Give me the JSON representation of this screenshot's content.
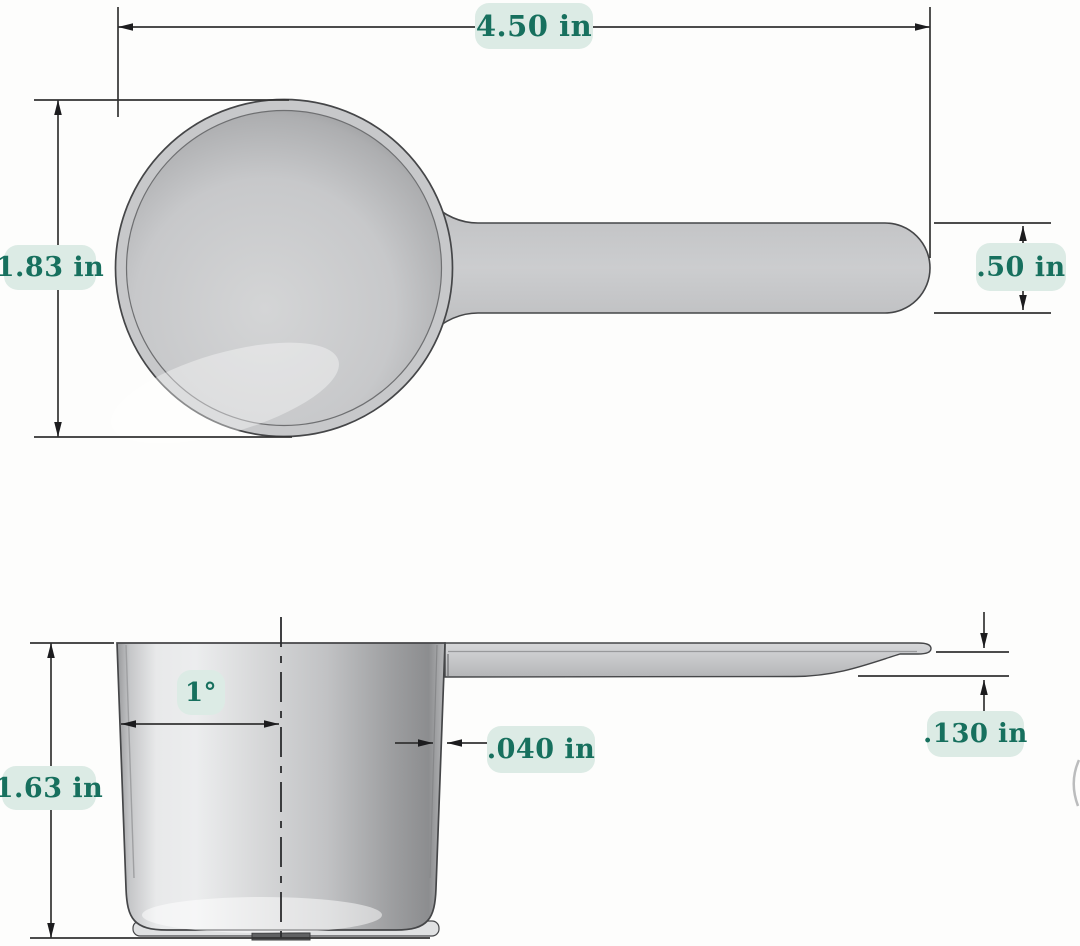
{
  "diagram": {
    "subject": "measuring-scoop-dimension-drawing",
    "colors": {
      "label_background": "#dcebe5",
      "label_text": "#17705e",
      "dimension_line": "#333333",
      "part_fill": "#c8c9cb",
      "outline": "#454648"
    },
    "views": {
      "top": {
        "name": "top-view",
        "dims": {
          "overall_length": "4.50 in",
          "bowl_diameter": "1.83 in",
          "handle_width": ".50 in"
        }
      },
      "side": {
        "name": "side-section-view",
        "dims": {
          "cup_height": "1.63 in",
          "draft_angle": "1°",
          "wall_thickness": ".040 in",
          "handle_thickness": ".130 in"
        }
      }
    }
  }
}
